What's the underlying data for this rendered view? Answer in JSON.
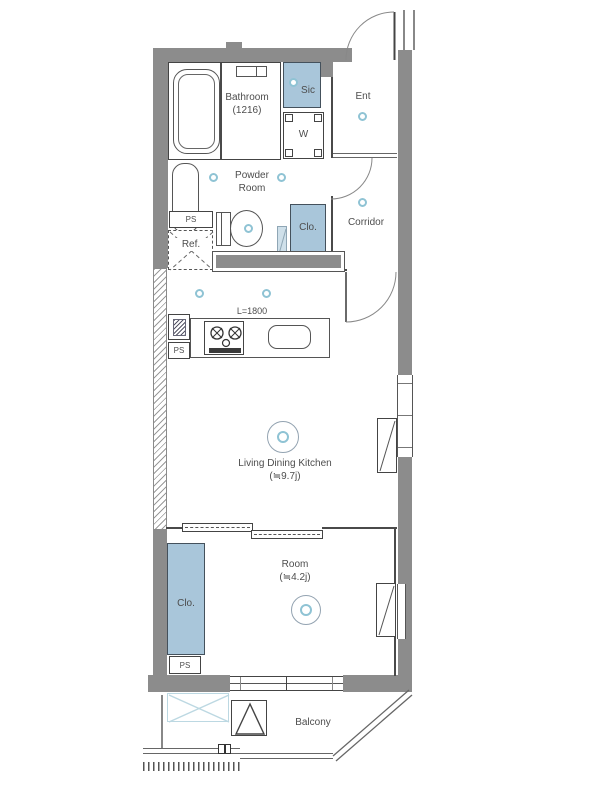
{
  "floorplan": {
    "rooms": {
      "bathroom": {
        "name": "Bathroom",
        "size": "(1216)"
      },
      "sic": {
        "name": "Sic"
      },
      "ent": {
        "name": "Ent"
      },
      "washer": {
        "name": "W"
      },
      "powder": {
        "line1": "Powder",
        "line2": "Room"
      },
      "corridor": {
        "name": "Corridor"
      },
      "clo_upper": {
        "name": "Clo."
      },
      "clo_lower": {
        "name": "Clo."
      },
      "ldk": {
        "name": "Living Dining Kitchen",
        "size": "(≒9.7j)"
      },
      "room": {
        "name": "Room",
        "size": "(≒4.2j)"
      },
      "balcony": {
        "name": "Balcony"
      }
    },
    "fixtures": {
      "ps_upper": "PS",
      "ps_kitchen": "PS",
      "ps_lower": "PS",
      "ref": "Ref.",
      "counter_length": "L=1800"
    },
    "colors": {
      "wall": "#8c8c8c",
      "closet_fill": "#a9c6da",
      "light_fixture": "#8fc3d4",
      "text": "#4d4d4d",
      "balcony_hatch": "#bcd8e2"
    }
  }
}
